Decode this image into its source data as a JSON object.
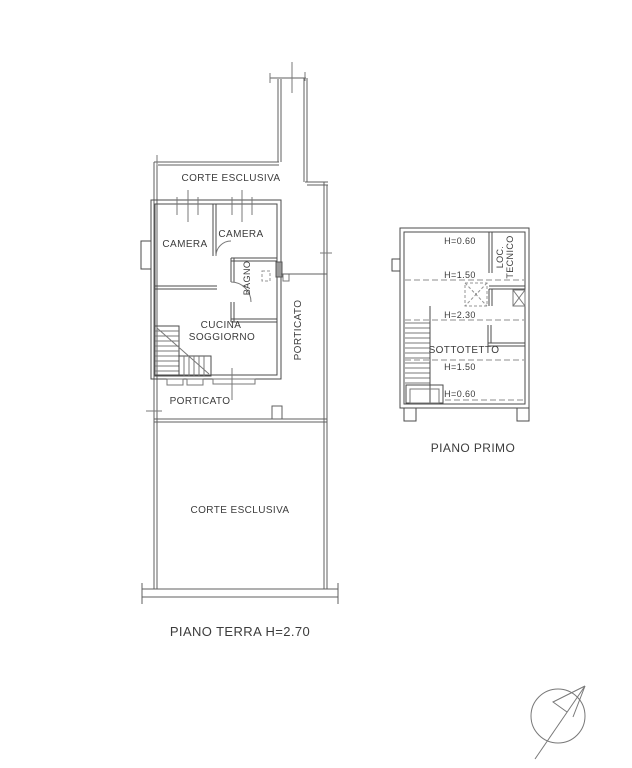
{
  "document": {
    "type": "floor-plan-drawing"
  },
  "ground_floor": {
    "caption": "PIANO TERRA H=2.70",
    "rooms": {
      "corte_top": "CORTE ESCLUSIVA",
      "camera_left": "CAMERA",
      "camera_right": "CAMERA",
      "bagno": "BAGNO",
      "cucina": "CUCINA",
      "soggiorno": "SOGGIORNO",
      "porticato_side": "PORTICATO",
      "porticato_front": "PORTICATO",
      "corte_bottom": "CORTE ESCLUSIVA"
    }
  },
  "first_floor": {
    "caption": "PIANO PRIMO",
    "rooms": {
      "sottotetto": "SOTTOTETTO",
      "loc_tecnico_line1": "LOC.",
      "loc_tecnico_line2": "TECNICO"
    },
    "heights": {
      "top": "H=0.60",
      "upper_mid": "H=1.50",
      "ridge": "H=2.30",
      "lower_mid": "H=1.50",
      "bottom": "H=0.60"
    }
  },
  "icons": {
    "compass": "north-arrow"
  },
  "colors": {
    "wall": "#4b4b4b",
    "bound": "#5f5f5f",
    "dash": "#8c8c8c",
    "text": "#3c3c3c",
    "background": "#ffffff"
  }
}
